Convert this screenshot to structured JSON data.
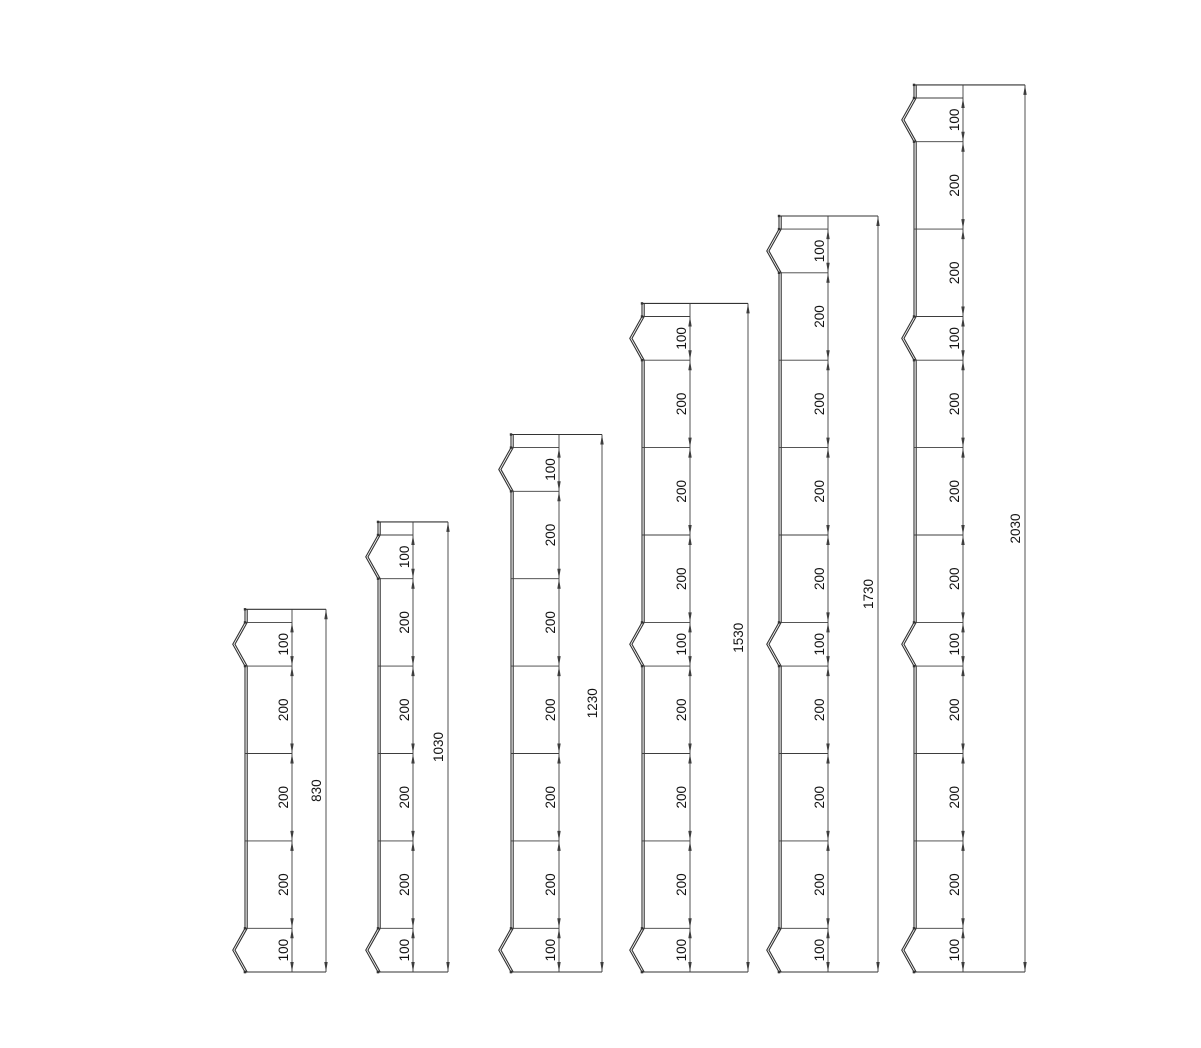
{
  "page": {
    "background": "#ffffff"
  },
  "drawing": {
    "canvas": {
      "width": 1201,
      "height": 1048
    },
    "units_to_px": 0.437,
    "baseline_y": 972,
    "style": {
      "profile_color": "#333333",
      "dim_color": "#3d3d3d",
      "text_color": "#141414",
      "profile_stroke": 1.1,
      "dim_stroke": 0.9,
      "font_size": 13.5,
      "sheet_thickness_px": 2.2,
      "chevron_depth_units": 28,
      "top_margin_units": 30,
      "arrow_len": 10,
      "arrow_halfwidth": 1.7,
      "joint_dot_size": 2.4,
      "chain_label_gap": 4,
      "overall_label_gap": 5
    },
    "pales": [
      {
        "name": "pale-830",
        "total": 830,
        "total_label": "830",
        "segments": [
          100,
          200,
          200,
          200,
          100
        ],
        "x_edge": 245,
        "x_chain": 292,
        "x_overall": 326
      },
      {
        "name": "pale-1030",
        "total": 1030,
        "total_label": "1030",
        "segments": [
          100,
          200,
          200,
          200,
          200,
          100
        ],
        "x_edge": 378,
        "x_chain": 413,
        "x_overall": 448
      },
      {
        "name": "pale-1230",
        "total": 1230,
        "total_label": "1230",
        "segments": [
          100,
          200,
          200,
          200,
          200,
          200,
          100
        ],
        "x_edge": 511,
        "x_chain": 559,
        "x_overall": 602
      },
      {
        "name": "pale-1530",
        "total": 1530,
        "total_label": "1530",
        "segments": [
          100,
          200,
          200,
          200,
          100,
          200,
          200,
          200,
          100
        ],
        "x_edge": 642,
        "x_chain": 690,
        "x_overall": 748
      },
      {
        "name": "pale-1730",
        "total": 1730,
        "total_label": "1730",
        "segments": [
          100,
          200,
          200,
          200,
          200,
          100,
          200,
          200,
          200,
          100
        ],
        "x_edge": 779,
        "x_chain": 828,
        "x_overall": 878
      },
      {
        "name": "pale-2030",
        "total": 2030,
        "total_label": "2030",
        "segments": [
          100,
          200,
          200,
          100,
          200,
          200,
          200,
          100,
          200,
          200,
          200,
          100
        ],
        "x_edge": 914,
        "x_chain": 963,
        "x_overall": 1025
      }
    ]
  }
}
